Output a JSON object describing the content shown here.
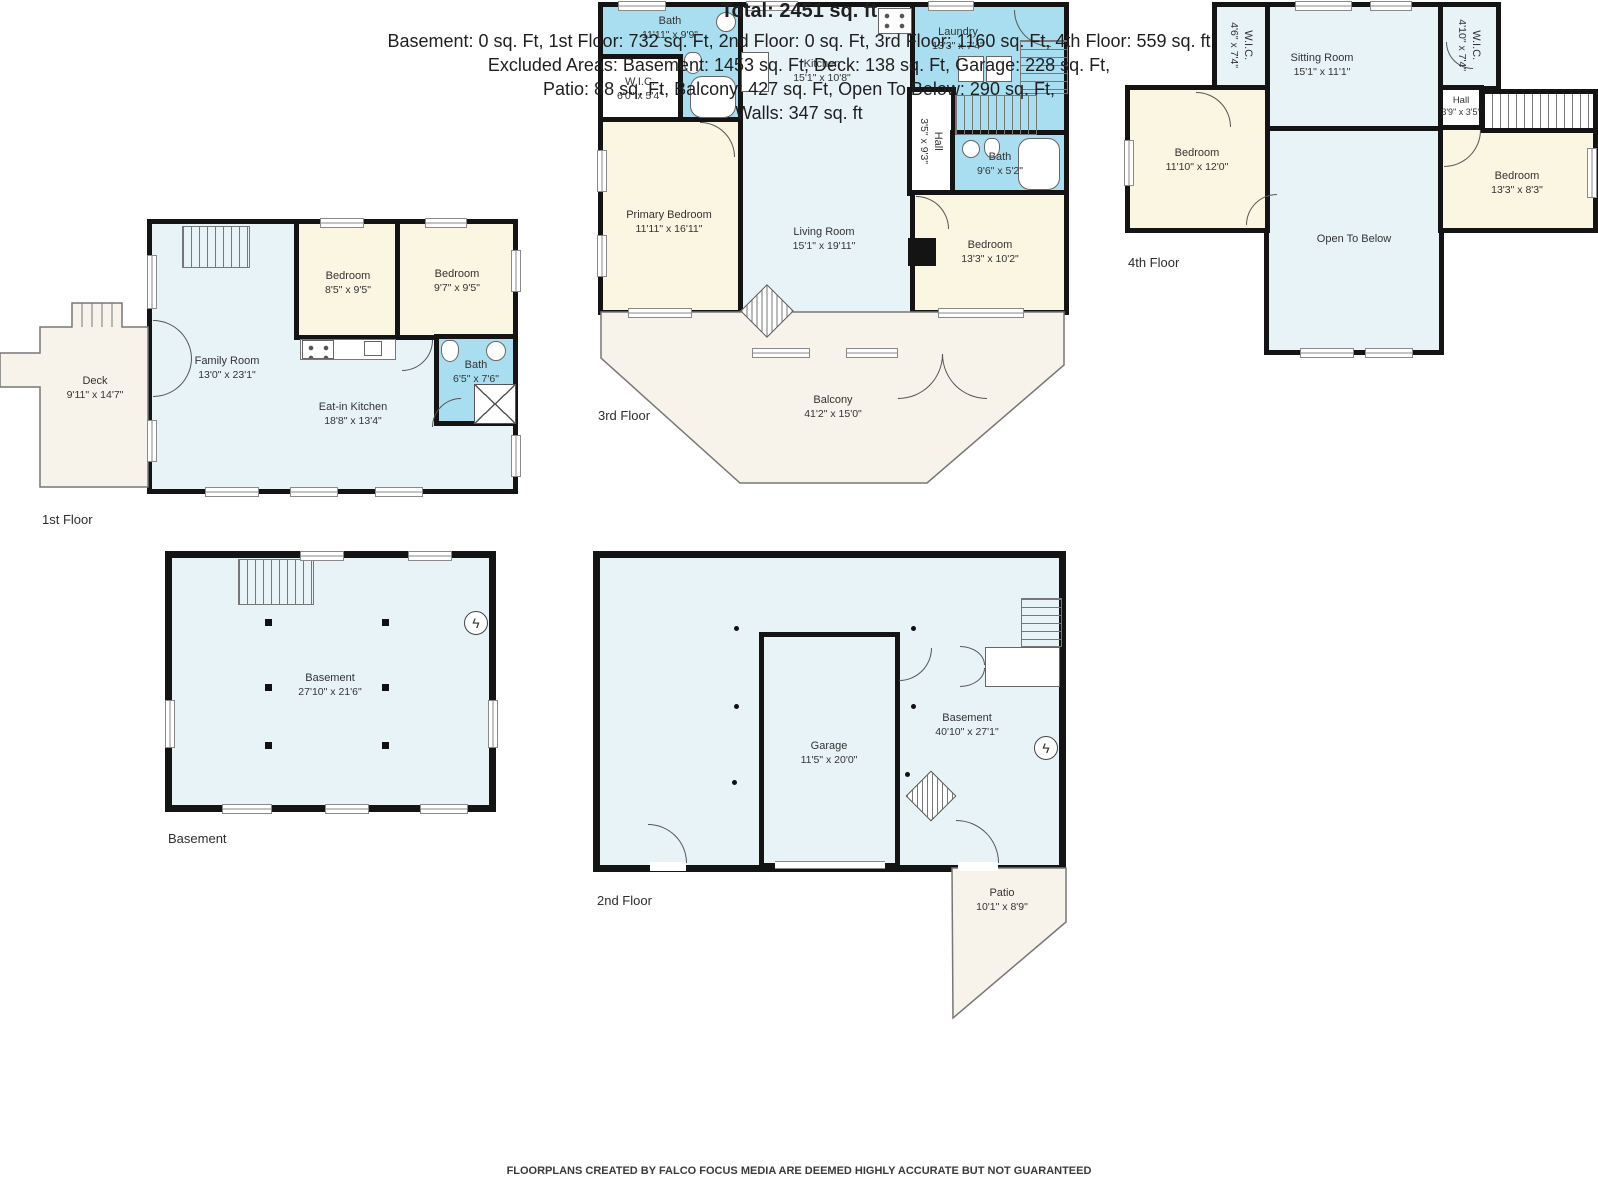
{
  "colors": {
    "wall": "#141414",
    "wet_room": "#a9def0",
    "bedroom": "#faf6e2",
    "interior": "#e8f3f8",
    "outdoor": "#f7f3ea"
  },
  "icons": {
    "electrical": "ϟ"
  },
  "floors": {
    "first": {
      "label": "1st Floor",
      "rooms": {
        "deck": {
          "name": "Deck",
          "dims": "9'11\" x 14'7\""
        },
        "family": {
          "name": "Family Room",
          "dims": "13'0\" x 23'1\""
        },
        "bedroom_a": {
          "name": "Bedroom",
          "dims": "8'5\" x 9'5\""
        },
        "bedroom_b": {
          "name": "Bedroom",
          "dims": "9'7\" x 9'5\""
        },
        "bath": {
          "name": "Bath",
          "dims": "6'5\" x 7'6\""
        },
        "eat_in_kitchen": {
          "name": "Eat-in Kitchen",
          "dims": "18'8\" x 13'4\""
        }
      }
    },
    "second": {
      "label": "2nd Floor",
      "rooms": {
        "garage": {
          "name": "Garage",
          "dims": "11'5\" x 20'0\""
        },
        "basement": {
          "name": "Basement",
          "dims": "40'10\" x 27'1\""
        },
        "patio": {
          "name": "Patio",
          "dims": "10'1\" x 8'9\""
        }
      }
    },
    "third": {
      "label": "3rd Floor",
      "rooms": {
        "bath_a": {
          "name": "Bath",
          "dims": "11'11\" x 9'9\""
        },
        "wic": {
          "name": "W.I.C.",
          "dims": "6'0\" x 5'4\""
        },
        "kitchen": {
          "name": "Kitchen",
          "dims": "15'1\" x 10'8\""
        },
        "laundry": {
          "name": "Laundry",
          "dims": "13'3\" x 7'4\""
        },
        "hall": {
          "name": "Hall",
          "dims": "3'5\" x 9'3\""
        },
        "bath_b": {
          "name": "Bath",
          "dims": "9'6\" x 5'2\""
        },
        "primary_bedroom": {
          "name": "Primary Bedroom",
          "dims": "11'11\" x 16'11\""
        },
        "living_room": {
          "name": "Living Room",
          "dims": "15'1\" x 19'11\""
        },
        "bedroom": {
          "name": "Bedroom",
          "dims": "13'3\" x 10'2\""
        },
        "balcony": {
          "name": "Balcony",
          "dims": "41'2\" x 15'0\""
        }
      }
    },
    "fourth": {
      "label": "4th Floor",
      "rooms": {
        "wic_left": {
          "name": "W.I.C.",
          "dims": "4'6\" x 7'4\""
        },
        "sitting_room": {
          "name": "Sitting Room",
          "dims": "15'1\" x 11'1\""
        },
        "wic_right": {
          "name": "W.I.C.",
          "dims": "4'10\" x 7'4\""
        },
        "hall": {
          "name": "Hall",
          "dims": "3'9\" x 3'5\""
        },
        "bedroom_left": {
          "name": "Bedroom",
          "dims": "11'10\" x 12'0\""
        },
        "bedroom_right": {
          "name": "Bedroom",
          "dims": "13'3\" x 8'3\""
        },
        "open_to_below": {
          "name": "Open To Below",
          "dims": ""
        }
      }
    },
    "basement": {
      "label": "Basement",
      "rooms": {
        "basement": {
          "name": "Basement",
          "dims": "27'10\" x 21'6\""
        }
      }
    }
  },
  "summary": {
    "total": "Total: 2451 sq. ft",
    "line1": "Basement: 0 sq. Ft, 1st Floor: 732 sq. Ft, 2nd Floor: 0 sq. Ft, 3rd Floor: 1160 sq. Ft, 4th Floor: 559 sq. ft",
    "line2": "Excluded Areas: Basement: 1453 sq. Ft, Deck: 138 sq. Ft, Garage: 228 sq. Ft,",
    "line3": "Patio: 88 sq. Ft, Balcony: 427 sq. Ft, Open To Below: 290 sq. Ft,",
    "line4": "Walls: 347 sq. ft",
    "footer": "FLOORPLANS CREATED BY FALCO FOCUS MEDIA ARE DEEMED HIGHLY ACCURATE BUT NOT GUARANTEED"
  }
}
